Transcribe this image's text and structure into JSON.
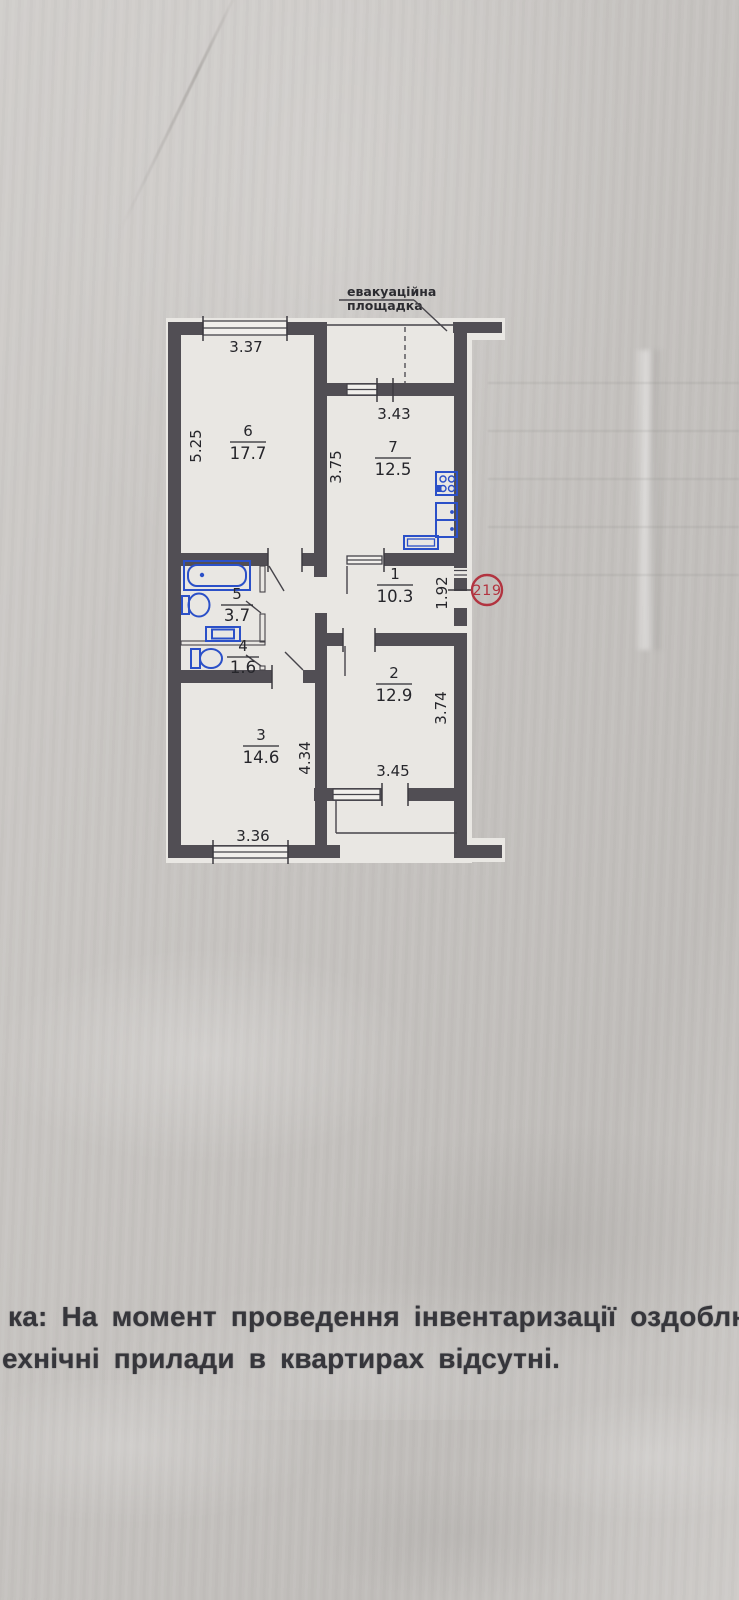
{
  "document": {
    "note_line1": "ка: На момент проведення інвентаризації оздоблюваль",
    "note_line2": "ехнічні прилади в квартирах відсутні."
  },
  "plan": {
    "apartment_stamp": "219",
    "evacuation_label_line1": "евакуаційна",
    "evacuation_label_line2": "площадка",
    "rooms": {
      "hall": {
        "number": "1",
        "area": "10.3"
      },
      "room2": {
        "number": "2",
        "area": "12.9"
      },
      "room3": {
        "number": "3",
        "area": "14.6"
      },
      "wc": {
        "number": "4",
        "area": "1.6"
      },
      "bath": {
        "number": "5",
        "area": "3.7"
      },
      "room6": {
        "number": "6",
        "area": "17.7"
      },
      "kitchen": {
        "number": "7",
        "area": "12.5"
      }
    },
    "dimensions": {
      "room6_width": "3.37",
      "room6_height": "5.25",
      "kitchen_width": "3.43",
      "kitchen_height": "3.75",
      "hall_right": "1.92",
      "room2_height": "3.74",
      "room2_width": "3.45",
      "room3_height": "4.34",
      "room3_width": "3.36"
    },
    "colors": {
      "wall": "#514e54",
      "fixture": "#2b50c8",
      "stamp": "#b23440"
    }
  }
}
